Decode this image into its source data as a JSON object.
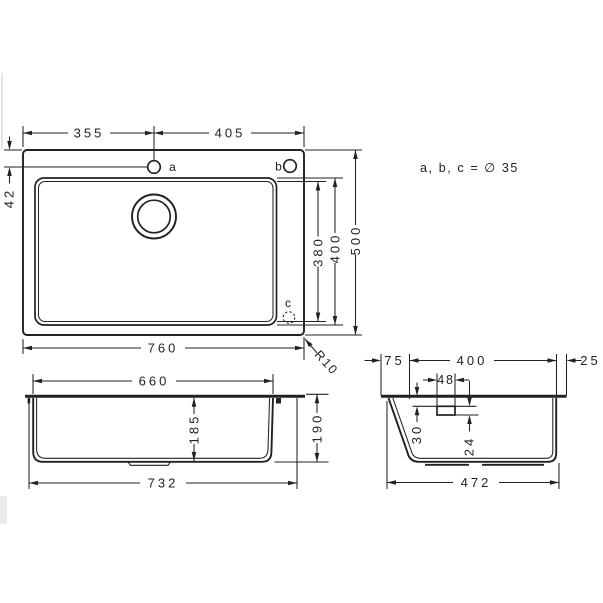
{
  "note": {
    "holes_note": "a, b, c = ∅ 35"
  },
  "top_view": {
    "d355": "355",
    "d405": "405",
    "d42": "42",
    "d380": "380",
    "d400": "400",
    "d500": "500",
    "d760": "760",
    "r10": "R10",
    "hole_a": "a",
    "hole_b": "b",
    "hole_c": "c"
  },
  "front_view": {
    "d660": "660",
    "d185": "185",
    "d190": "190",
    "d732": "732"
  },
  "side_view": {
    "d75": "75",
    "d400": "400",
    "d25": "25",
    "d48": "48",
    "d30": "30",
    "d24": "24",
    "d472": "472"
  }
}
